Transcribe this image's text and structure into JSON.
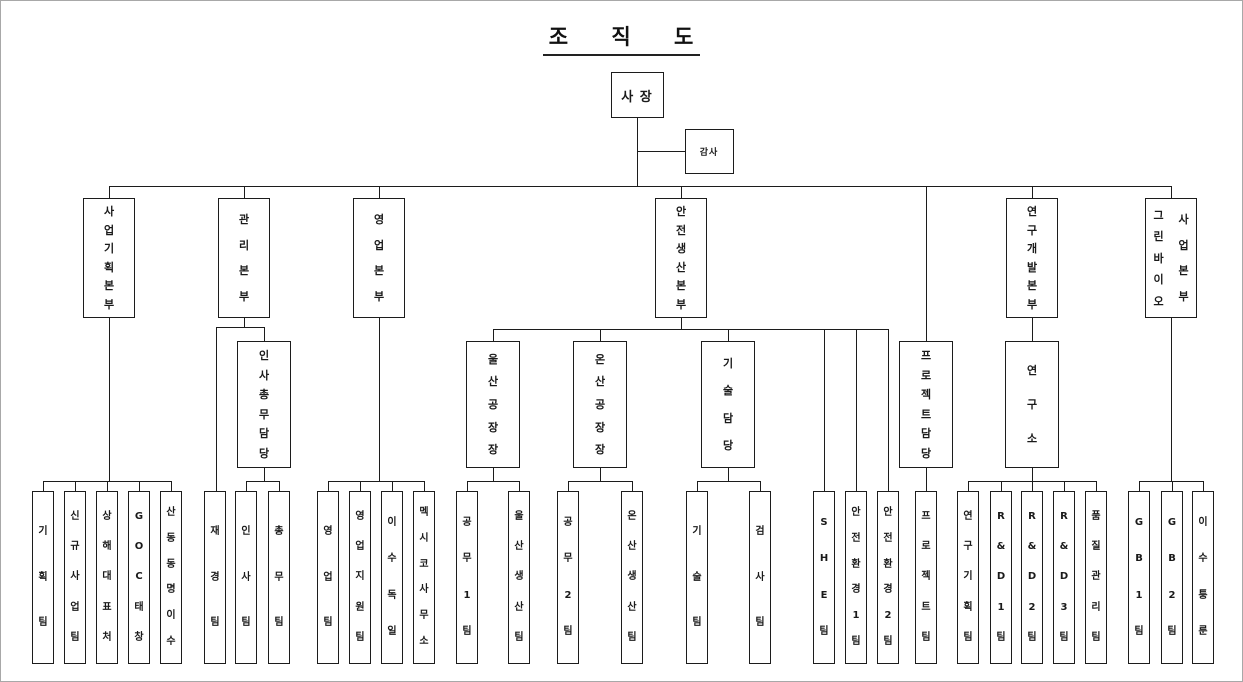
{
  "title": "조 직 도",
  "nodes": [
    {
      "id": "president",
      "name": "사 장",
      "parent": null,
      "level": 0,
      "cx": 636,
      "top": 71,
      "w": 53,
      "h": 46,
      "orient": "h",
      "fs": 13
    },
    {
      "id": "auditor",
      "name": "감사",
      "parent": "president",
      "level": 0,
      "cx": 708,
      "top": 128,
      "w": 49,
      "h": 45,
      "orient": "h",
      "fs": 9
    },
    {
      "id": "business-planning-hq",
      "name": "사업기획본부",
      "parent": "president",
      "level": 1,
      "cx": 108
    },
    {
      "id": "management-hq",
      "name": "관리본부",
      "parent": "president",
      "level": 1,
      "cx": 243
    },
    {
      "id": "sales-hq",
      "name": "영업본부",
      "parent": "president",
      "level": 1,
      "cx": 378
    },
    {
      "id": "safety-production-hq",
      "name": "안전생산본부",
      "parent": "president",
      "level": 1,
      "cx": 680
    },
    {
      "id": "rnd-hq",
      "name": "연구개발본부",
      "parent": "president",
      "level": 1,
      "cx": 1031
    },
    {
      "id": "green-bio-hq",
      "name": "그린바이오사업본부",
      "columns": [
        "그린바이오",
        "사업본부"
      ],
      "parent": "president",
      "level": 1,
      "cx": 1170
    },
    {
      "id": "hr-general-affairs",
      "name": "인사총무담당",
      "parent": "management-hq",
      "level": 2,
      "cx": 263
    },
    {
      "id": "ulsan-plant-manager",
      "name": "울산공장장",
      "parent": "safety-production-hq",
      "level": 2,
      "cx": 492
    },
    {
      "id": "onsan-plant-manager",
      "name": "온산공장장",
      "parent": "safety-production-hq",
      "level": 2,
      "cx": 599
    },
    {
      "id": "technology-division",
      "name": "기술담당",
      "parent": "safety-production-hq",
      "level": 2,
      "cx": 727
    },
    {
      "id": "project-division",
      "name": "프로젝트담당",
      "parent": "president",
      "level": 2,
      "cx": 925
    },
    {
      "id": "research-institute",
      "name": "연구소",
      "parent": "rnd-hq",
      "level": 2,
      "cx": 1031
    },
    {
      "id": "planning-team",
      "name": "기획팀",
      "parent": "business-planning-hq",
      "level": 3,
      "cx": 42
    },
    {
      "id": "new-business-team",
      "name": "신규사업팀",
      "parent": "business-planning-hq",
      "level": 3,
      "cx": 74
    },
    {
      "id": "shanghai-rep-office",
      "name": "상해대표처",
      "parent": "business-planning-hq",
      "level": 3,
      "cx": 106
    },
    {
      "id": "goc-taechang",
      "name": "GOC태창",
      "parent": "business-planning-hq",
      "level": 3,
      "cx": 138
    },
    {
      "id": "shandong-dongmyeong-isu",
      "name": "산동동명이수",
      "parent": "business-planning-hq",
      "level": 3,
      "cx": 170
    },
    {
      "id": "finance-team",
      "name": "재경팀",
      "parent": "management-hq",
      "level": 3,
      "cx": 214
    },
    {
      "id": "hr-team",
      "name": "인사팀",
      "parent": "hr-general-affairs",
      "level": 3,
      "cx": 245
    },
    {
      "id": "general-affairs-team",
      "name": "총무팀",
      "parent": "hr-general-affairs",
      "level": 3,
      "cx": 278
    },
    {
      "id": "sales-team",
      "name": "영업팀",
      "parent": "sales-hq",
      "level": 3,
      "cx": 327
    },
    {
      "id": "sales-support-team",
      "name": "영업지원팀",
      "parent": "sales-hq",
      "level": 3,
      "cx": 359
    },
    {
      "id": "isu-germany",
      "name": "이수독일",
      "parent": "sales-hq",
      "level": 3,
      "cx": 391
    },
    {
      "id": "mexico-office",
      "name": "멕시코사무소",
      "parent": "sales-hq",
      "level": 3,
      "cx": 423
    },
    {
      "id": "engineering-team-1",
      "name": "공무1팀",
      "parent": "ulsan-plant-manager",
      "level": 3,
      "cx": 466
    },
    {
      "id": "ulsan-production-team",
      "name": "울산생산팀",
      "parent": "ulsan-plant-manager",
      "level": 3,
      "cx": 518
    },
    {
      "id": "engineering-team-2",
      "name": "공무2팀",
      "parent": "onsan-plant-manager",
      "level": 3,
      "cx": 567
    },
    {
      "id": "onsan-production-team",
      "name": "온산생산팀",
      "parent": "onsan-plant-manager",
      "level": 3,
      "cx": 631
    },
    {
      "id": "technology-team",
      "name": "기술팀",
      "parent": "technology-division",
      "level": 3,
      "cx": 696
    },
    {
      "id": "inspection-team",
      "name": "검사팀",
      "parent": "technology-division",
      "level": 3,
      "cx": 759
    },
    {
      "id": "she-team",
      "name": "SHE팀",
      "parent": "safety-production-hq",
      "level": 3,
      "cx": 823
    },
    {
      "id": "safety-environment-team-1",
      "name": "안전환경1팀",
      "parent": "safety-production-hq",
      "level": 3,
      "cx": 855
    },
    {
      "id": "safety-environment-team-2",
      "name": "안전환경2팀",
      "parent": "safety-production-hq",
      "level": 3,
      "cx": 887
    },
    {
      "id": "project-team",
      "name": "프로젝트팀",
      "parent": "project-division",
      "level": 3,
      "cx": 925
    },
    {
      "id": "research-planning-team",
      "name": "연구기획팀",
      "parent": "research-institute",
      "level": 3,
      "cx": 967
    },
    {
      "id": "rnd-team-1",
      "name": "R&D1팀",
      "parent": "research-institute",
      "level": 3,
      "cx": 1000
    },
    {
      "id": "rnd-team-2",
      "name": "R&D2팀",
      "parent": "research-institute",
      "level": 3,
      "cx": 1031
    },
    {
      "id": "rnd-team-3",
      "name": "R&D3팀",
      "parent": "research-institute",
      "level": 3,
      "cx": 1063
    },
    {
      "id": "quality-management-team",
      "name": "품질관리팀",
      "parent": "research-institute",
      "level": 3,
      "cx": 1095
    },
    {
      "id": "gb-team-1",
      "name": "GB1팀",
      "parent": "green-bio-hq",
      "level": 3,
      "cx": 1138
    },
    {
      "id": "gb-team-2",
      "name": "GB2팀",
      "parent": "green-bio-hq",
      "level": 3,
      "cx": 1171
    },
    {
      "id": "isu-tongrun",
      "name": "이수퉁룬",
      "parent": "green-bio-hq",
      "level": 3,
      "cx": 1202
    }
  ]
}
